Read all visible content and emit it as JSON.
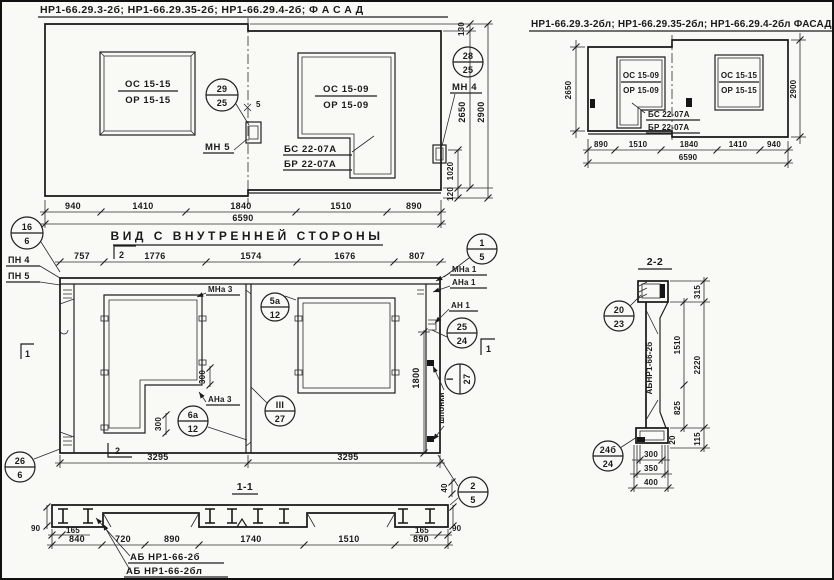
{
  "facade": {
    "title": "НР1-66.29.3-2б;  НР1-66.29.35-2б;  НР1-66.29.4-2б;      Ф А С А Д",
    "window_left": {
      "top": "ОС 15-15",
      "bottom": "ОР 15-15"
    },
    "window_right": {
      "top": "ОС 15-09",
      "bottom": "ОР 15-09"
    },
    "balcony": {
      "top": "БС 22-07А",
      "bottom": "БР 22-07А"
    },
    "callout_left": {
      "num": "29",
      "sheet": "25"
    },
    "callout_right": {
      "num": "28",
      "sheet": "25"
    },
    "mn5": "МН 5",
    "mn4": "МН 4",
    "gap": "5",
    "dims_bottom": [
      "940",
      "1410",
      "1840",
      "1510",
      "890"
    ],
    "dim_total": "6590",
    "dim_130": "130",
    "dim_2650": "2650",
    "dim_1020": "1020",
    "dim_120": "120",
    "dim_2900": "2900"
  },
  "facade_l": {
    "title": "НР1-66.29.3-2бл;  НР1-66.29.35-2бл;  НР1-66.29.4-2бл  ФАСАД",
    "window_left": {
      "top": "ОС 15-09",
      "bottom": "ОР 15-09"
    },
    "balcony": {
      "top": "БС 22-07А",
      "bottom": "БР 22-07А"
    },
    "window_right": {
      "top": "ОС 15-15",
      "bottom": "ОР 15-15"
    },
    "dims_bottom": [
      "890",
      "1510",
      "1840",
      "1410",
      "940"
    ],
    "dim_total": "6590",
    "dim_2650": "2650",
    "dim_2900": "2900"
  },
  "inner": {
    "title": "ВИД С ВНУТРЕННЕЙ СТОРОНЫ",
    "dims_top": [
      "757",
      "1776",
      "1574",
      "1676",
      "807"
    ],
    "dims_bottom": [
      "3295",
      "3295"
    ],
    "dim_1800": "1800",
    "dim_300a": "300",
    "dim_300b": "300",
    "dim_40": "40",
    "pn4": "ПН 4",
    "pn5": "ПН 5",
    "mna1": "МНа 1",
    "ana1": "АНа 1",
    "an1": "АН 1",
    "mna3": "МНа 3",
    "ana3": "АНа 3",
    "shponki": "шпонки",
    "sec1": "1",
    "sec2": "2",
    "c16": {
      "num": "16",
      "sheet": "6"
    },
    "c26": {
      "num": "26",
      "sheet": "6"
    },
    "c1_5": {
      "num": "1",
      "sheet": "5"
    },
    "c2_5": {
      "num": "2",
      "sheet": "5"
    },
    "c5a": {
      "num": "5а",
      "sheet": "12"
    },
    "c6a": {
      "num": "6а",
      "sheet": "12"
    },
    "cIII": {
      "num": "III",
      "sheet": "27"
    },
    "cI": {
      "num": "I",
      "sheet": "27"
    },
    "c25": {
      "num": "25",
      "sheet": "24"
    }
  },
  "sec11": {
    "title": "1-1",
    "dim_90l": "90",
    "dim_90r": "90",
    "dim_165l": "165",
    "dim_165r": "165",
    "dims": [
      "840",
      "720",
      "890",
      "1740",
      "1510",
      "890"
    ],
    "mark_a": "АБ НР1-66-2б",
    "mark_b": "АБ НР1-66-2бл"
  },
  "sec22": {
    "title": "2-2",
    "mark": "АБНР1-66-2б",
    "c20": {
      "num": "20",
      "sheet": "23"
    },
    "c24": {
      "num": "24б",
      "sheet": "24"
    },
    "dim_315": "315",
    "dim_1510": "1510",
    "dim_2220": "2220",
    "dim_825": "825",
    "dim_20": "20",
    "dim_115": "115",
    "dims_bottom": [
      "300",
      "350",
      "400"
    ]
  }
}
